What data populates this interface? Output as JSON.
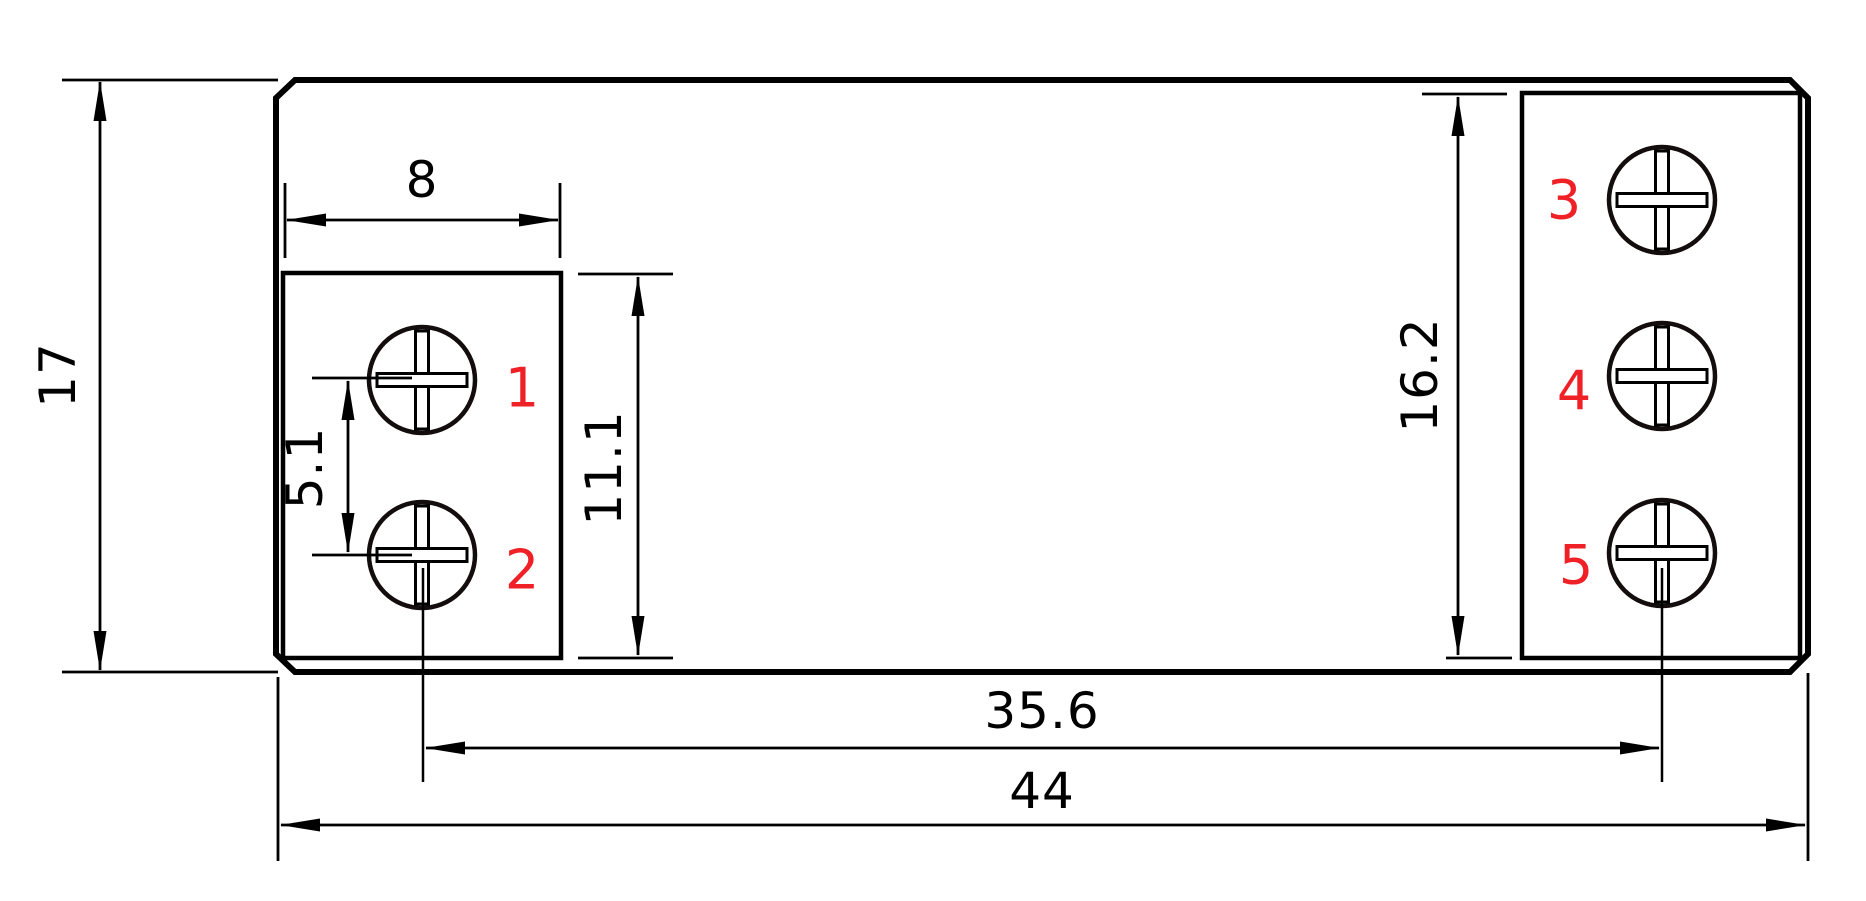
{
  "drawing": {
    "type": "technical-dimension-drawing",
    "view": "top view with screw terminals",
    "dimensions": {
      "total_height": "17",
      "left_block_width": "8",
      "terminal_pitch": "5.1",
      "left_block_height": "11.1",
      "right_block_height": "16.2",
      "terminal_center_span": "35.6",
      "total_width": "44"
    },
    "terminals": [
      {
        "number": "1"
      },
      {
        "number": "2"
      },
      {
        "number": "3"
      },
      {
        "number": "4"
      },
      {
        "number": "5"
      }
    ],
    "colors": {
      "line": "#000000",
      "terminal_number": "#ef2127",
      "background": "#ffffff"
    }
  }
}
